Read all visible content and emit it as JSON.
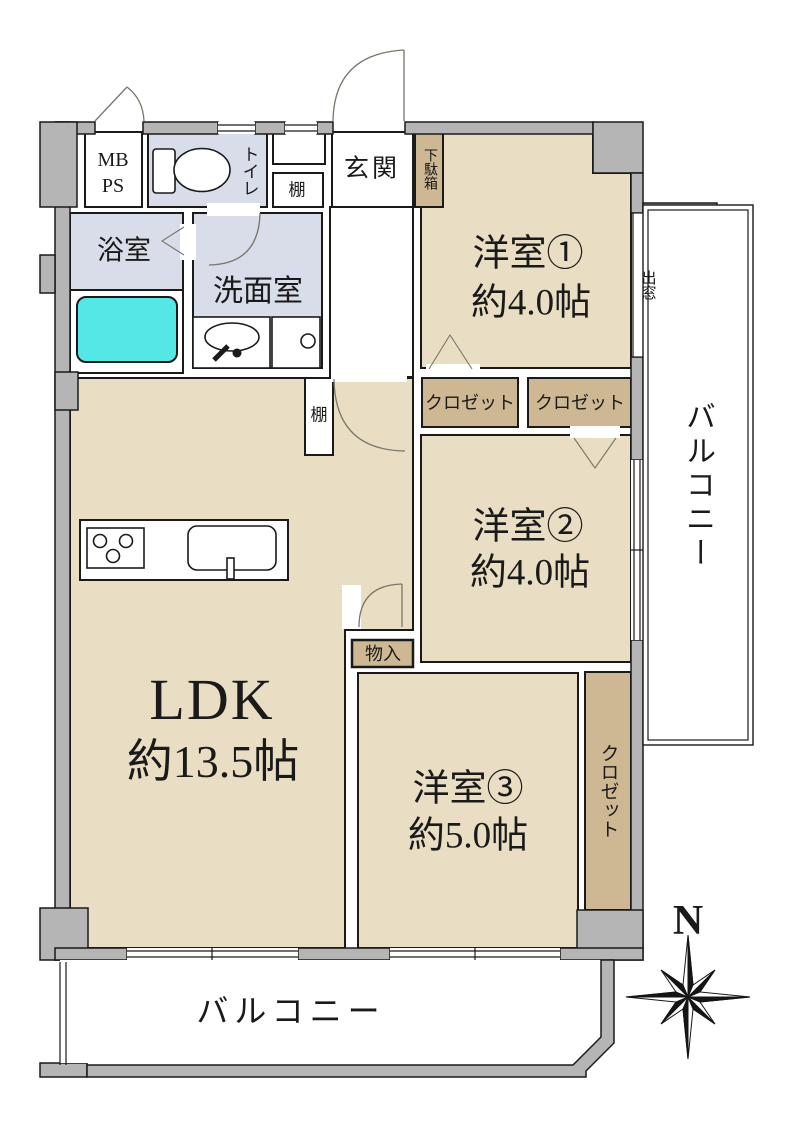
{
  "rooms": {
    "ldk": {
      "label": "LDK",
      "size": "約13.5帖"
    },
    "western1": {
      "label": "洋室①",
      "size": "約4.0帖"
    },
    "western2": {
      "label": "洋室②",
      "size": "約4.0帖"
    },
    "western3": {
      "label": "洋室③",
      "size": "約5.0帖"
    },
    "bathroom": {
      "label": "浴室"
    },
    "washroom": {
      "label": "洗面室"
    },
    "toilet": {
      "label": "トイレ"
    },
    "entrance": {
      "label": "玄関"
    },
    "balcony_bottom": {
      "label": "バルコニー"
    },
    "balcony_right": {
      "label": "バルコニー"
    }
  },
  "storage": {
    "shoe_cabinet": "下駄箱",
    "shelf_entrance": "棚",
    "shelf_ldk": "棚",
    "closet1": "クロゼット",
    "closet2": "クロゼット",
    "closet3": "クロゼット",
    "storage_small": "物入",
    "bay_window": "出窓",
    "meter_box_line1": "MB",
    "meter_box_line2": "PS"
  },
  "compass": {
    "north": "N"
  },
  "colors": {
    "room_tan": "#e9dec3",
    "closet_tan": "#cdb893",
    "wet_area": "#d9dde9",
    "bathtub": "#55e6e6",
    "wall_gray": "#b5b5b5",
    "line": "#1a1a1a"
  }
}
